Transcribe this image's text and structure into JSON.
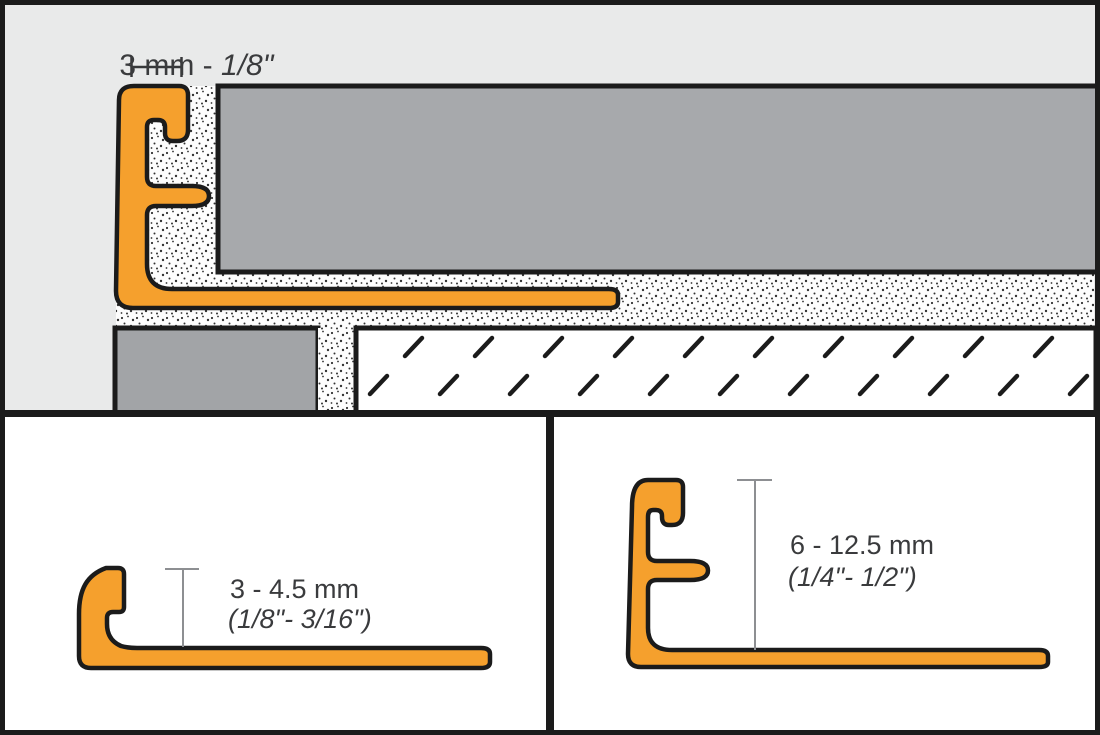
{
  "diagram": {
    "type": "tile-edge-profile-technical-drawing",
    "top_panel": {
      "dimension_metric": "3 mm - ",
      "dimension_imperial": "1/8\""
    },
    "bottom_left_panel": {
      "height_range_metric": "3 - 4.5 mm",
      "height_range_imperial": "(1/8\"- 3/16\")"
    },
    "bottom_right_panel": {
      "height_range_metric": "6 - 12.5 mm",
      "height_range_imperial": "(1/4\"- 1/2\")"
    }
  },
  "colors": {
    "profile_orange": "#F5A02D",
    "outline_black": "#1B1B1B",
    "tile_gray": "#A7A9AC",
    "adjacent_covering_gray": "#A2A4A7",
    "top_panel_background": "#E9EAEA",
    "bottom_panel_background": "#FFFFFF",
    "label_text": "#3A3B3D",
    "dimension_line_gray": "#8D8F92"
  }
}
